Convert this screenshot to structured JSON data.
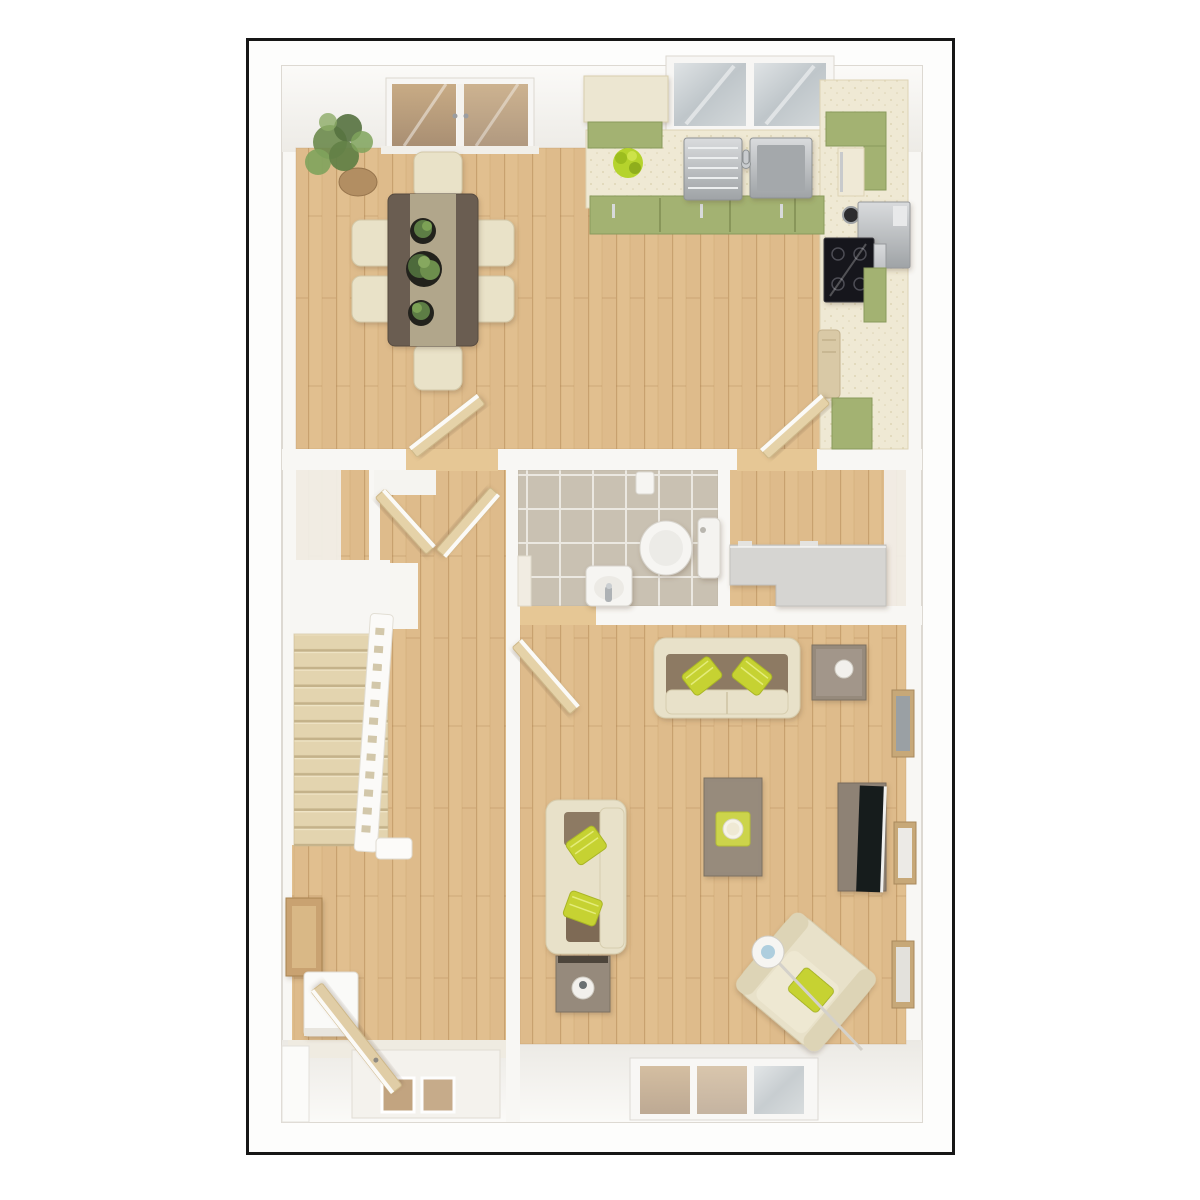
{
  "meta": {
    "description": "3D top-down architectural render of a ground-floor plan inside a thin black frame",
    "visible_text": []
  },
  "palette": {
    "frame_border": "#161616",
    "canvas": "#ffffff",
    "wall": "#f8f7f4",
    "wall_shade": "#eceae5",
    "wood_base": "#debb8b",
    "wood_threshold": "#e6c795",
    "carpet": "#e3d4af",
    "counter_cream": "#efe9d4",
    "cabinet_green": "#a3b272",
    "cabinet_green_dark": "#8a9a5c",
    "steel": "#b9bcbf",
    "hob_black": "#17161a",
    "table_dark_wood": "#6b5d51",
    "table_runner": "#b5aa8e",
    "chair_cream": "#e9e2c8",
    "sofa_cream": "#e8e1c9",
    "cushion_brown": "#8d7a64",
    "pillow_green": "#c6d232",
    "taupe_furniture": "#968a7b",
    "tv_black": "#191a1c",
    "tile_floor": "#c9c1b2",
    "gray_unit": "#d6d5d2",
    "door_wood": "#e5d2a8",
    "glass_warm": "#c2a480",
    "frame_wood": "#c7a878",
    "fixture_white": "#f6f5f2",
    "plant_green": "#6b8a4c",
    "plant_bright": "#b5d32c",
    "pot_dark": "#23211d"
  },
  "semantics": {
    "rooms": [
      "kitchen-dining-room",
      "hallway",
      "staircase",
      "storage-closet",
      "wc-bathroom",
      "storage-room",
      "living-room",
      "entrance-porch"
    ],
    "furniture": [
      "dining-table",
      "dining-chairs",
      "potted-plants",
      "kitchen-counter",
      "kitchen-sink",
      "hob",
      "oven-appliance",
      "kettle",
      "stairs",
      "banister",
      "toilet",
      "wash-basin",
      "gray-storage-unit",
      "sofa",
      "sofa-2",
      "armchair",
      "coffee-table",
      "side-table",
      "end-table",
      "tv-unit",
      "television",
      "floor-lamp",
      "table-lamp",
      "picture-frames",
      "wall-mirror",
      "console-shelf"
    ],
    "openings": [
      "french-doors",
      "kitchen-window",
      "living-room-window",
      "front-door",
      "interior-doors"
    ]
  }
}
